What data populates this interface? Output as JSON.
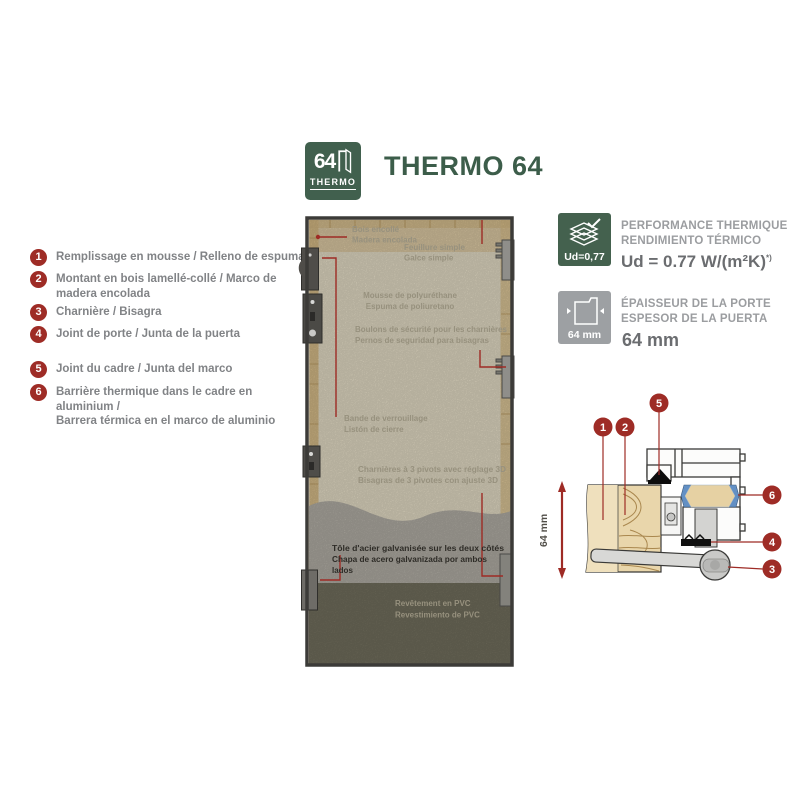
{
  "colors": {
    "accent_red": "#9e2c26",
    "brand_green": "#41604e",
    "title_green": "#3c5d4a",
    "thermal_break_blue": "#6390c4",
    "legend_text_gray": "#818386",
    "spec_text_gray": "#9b9da0"
  },
  "header": {
    "logo_number": "64",
    "logo_brand": "THERMO",
    "title": "THERMO 64"
  },
  "legend": {
    "items": [
      {
        "num": "1",
        "text": "Remplissage en mousse / Relleno de espuma"
      },
      {
        "num": "2",
        "text": "Montant en bois lamellé-collé / Marco de madera encolada"
      },
      {
        "num": "3",
        "text": "Charnière / Bisagra"
      },
      {
        "num": "4",
        "text": "Joint de porte / Junta de la puerta"
      },
      {
        "num": "5",
        "text": "Joint du cadre / Junta del marco"
      },
      {
        "num": "6",
        "text": "Barrière thermique dans le cadre en aluminium /",
        "text2": "Barrera térmica en el marco de aluminio"
      }
    ]
  },
  "door": {
    "labels": {
      "glued_wood": {
        "fr": "Bois encollé",
        "es": "Madera encolada"
      },
      "rebate": {
        "fr": "Feuillure simple",
        "es": "Galce simple"
      },
      "foam": {
        "fr": "Mousse de polyuréthane",
        "es": "Espuma de poliuretano"
      },
      "bolts": {
        "fr": "Boulons de sécurité pour les charnières",
        "es": "Pernos de seguridad para bisagras"
      },
      "locking_strip": {
        "fr": "Bande de verrouillage",
        "es": "Listón de cierre"
      },
      "hinges": {
        "fr": "Charnières à 3 pivots avec réglage 3D",
        "es": "Bisagras de 3 pivotes con ajuste 3D"
      },
      "steel_sheet": {
        "fr": "Tôle d'acier galvanisée sur les deux côtés",
        "es_1": "Chapa de acero galvanizada por ambos",
        "es_2": "lados"
      },
      "pvc": {
        "fr": "Revêtement en PVC",
        "es": "Revestimiento de PVC"
      }
    }
  },
  "specs": {
    "thermal": {
      "badge": "Ud=0,77",
      "line1": "PERFORMANCE THERMIQUE",
      "line2": "RENDIMIENTO TÉRMICO",
      "value": "Ud = 0.77 W/(m²K)",
      "note": "*)"
    },
    "thickness": {
      "badge": "64 mm",
      "line1": "ÉPAISSEUR DE LA PORTE",
      "line2": "ESPESOR DE LA PUERTA",
      "value": "64 mm"
    }
  },
  "cross_section": {
    "dimension": "64 mm",
    "callouts": {
      "c1": "1",
      "c2": "2",
      "c3": "3",
      "c4": "4",
      "c5": "5",
      "c6": "6"
    }
  }
}
